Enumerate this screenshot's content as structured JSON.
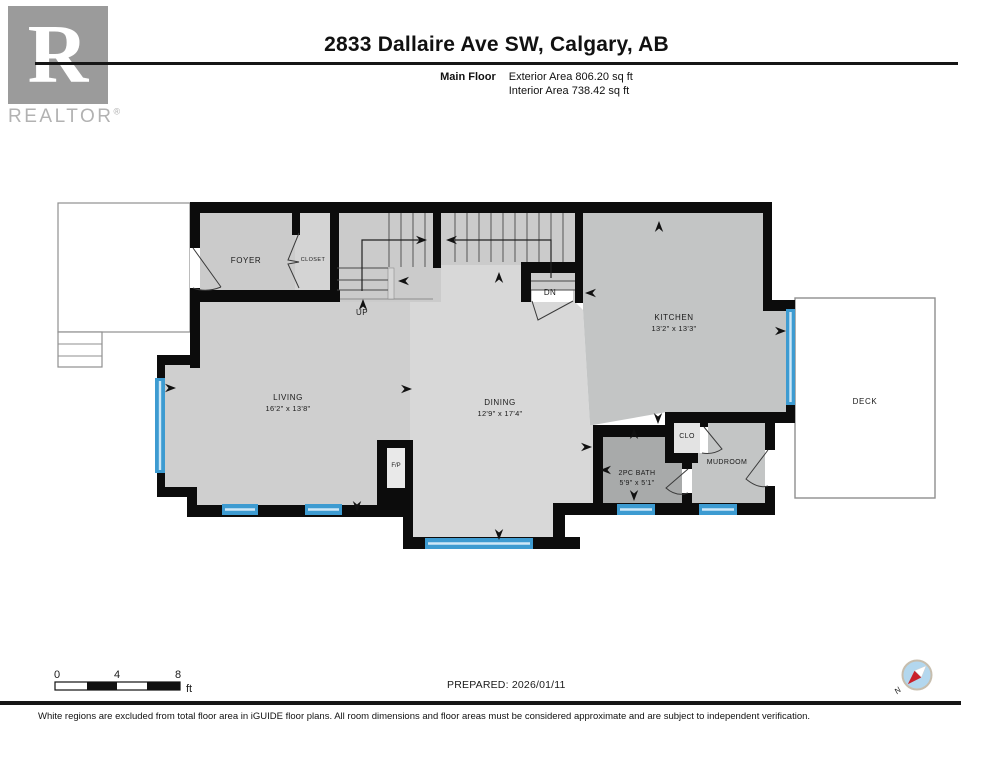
{
  "header": {
    "logo_letter": "R",
    "logo_text": "REALTOR",
    "logo_reg": "®",
    "title": "2833 Dallaire Ave SW, Calgary, AB",
    "floor_label": "Main Floor",
    "exterior_area": "Exterior Area 806.20 sq ft",
    "interior_area": "Interior Area 738.42 sq ft"
  },
  "plan": {
    "rooms": {
      "foyer": {
        "name": "FOYER"
      },
      "closet": {
        "name": "CLOSET"
      },
      "kitchen": {
        "name": "KITCHEN",
        "dims": "13'2\" x 13'3\""
      },
      "living": {
        "name": "LIVING",
        "dims": "16'2\" x 13'8\""
      },
      "dining": {
        "name": "DINING",
        "dims": "12'9\" x 17'4\""
      },
      "bath": {
        "name": "2PC BATH",
        "dims": "5'9\" x 5'1\""
      },
      "clo": {
        "name": "CLO"
      },
      "mudroom": {
        "name": "MUDROOM"
      },
      "deck": {
        "name": "DECK"
      },
      "fireplace": {
        "name": "F/P"
      }
    },
    "stairs": {
      "up": "UP",
      "down": "DN"
    }
  },
  "scale_bar": {
    "tick_0": "0",
    "tick_4": "4",
    "tick_8": "8",
    "unit": "ft"
  },
  "prepared_label": "PREPARED: 2026/01/11",
  "compass": {
    "north": "N"
  },
  "footer_note": "White regions are excluded from total floor area in iGUIDE floor plans. All room dimensions and floor areas must be considered approximate and are subject to independent verification.",
  "colors": {
    "wall_black": "#0c0c0c",
    "window_blue": "#3d9bd1",
    "compass_red": "#c9202a",
    "compass_blue": "#b3d7ee"
  }
}
